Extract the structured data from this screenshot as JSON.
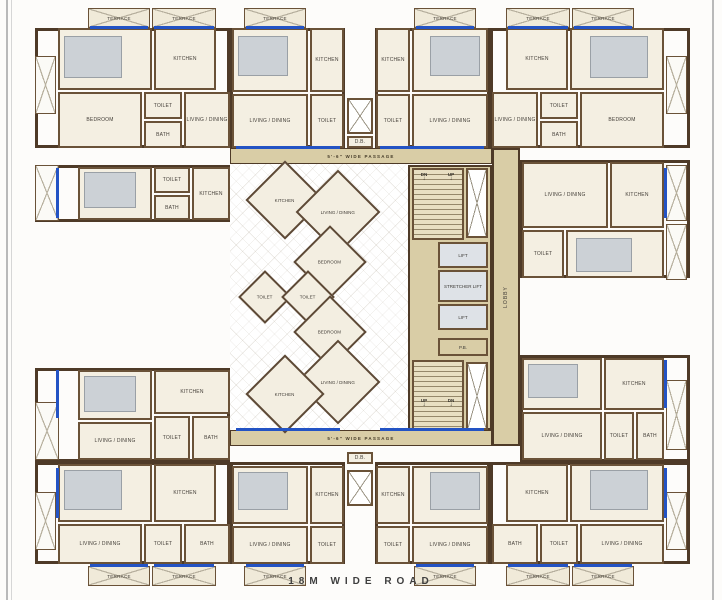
{
  "plan": {
    "road_label": "18M WIDE ROAD",
    "passage_top": "5'-6\" WIDE PASSAGE",
    "passage_bottom": "5'-6\" WIDE PASSAGE",
    "lobby_label": "LOBBY",
    "core": {
      "lift_top": "LIFT",
      "lift_middle": "STRETCHER LIFT",
      "lift_bottom": "LIFT",
      "pb_label": "P.B.",
      "stair_top_dn": "DN",
      "stair_top_up": "UP",
      "stair_bottom_up": "UP",
      "stair_bottom_dn": "DN"
    }
  },
  "colors": {
    "wall": "#6a5238",
    "outline": "#4e3a27",
    "room_fill": "#f4efe2",
    "terrace_fill": "#f0ead9",
    "passage_fill": "#d9cda6",
    "lift_fill": "#dee2e7",
    "window_blue": "#2353c4",
    "road_text": "#3f3f3f"
  },
  "plan_elements": {
    "wings": [
      {
        "x": 35,
        "y": 28,
        "w": 195,
        "h": 120
      },
      {
        "x": 230,
        "y": 28,
        "w": 115,
        "h": 120
      },
      {
        "x": 375,
        "y": 28,
        "w": 115,
        "h": 120
      },
      {
        "x": 490,
        "y": 28,
        "w": 200,
        "h": 120
      },
      {
        "x": 35,
        "y": 165,
        "w": 195,
        "h": 57
      },
      {
        "x": 520,
        "y": 160,
        "w": 170,
        "h": 118
      },
      {
        "x": 35,
        "y": 368,
        "w": 195,
        "h": 94
      },
      {
        "x": 520,
        "y": 355,
        "w": 170,
        "h": 107
      },
      {
        "x": 35,
        "y": 462,
        "w": 195,
        "h": 102
      },
      {
        "x": 230,
        "y": 462,
        "w": 115,
        "h": 102
      },
      {
        "x": 375,
        "y": 462,
        "w": 115,
        "h": 102
      },
      {
        "x": 490,
        "y": 462,
        "w": 200,
        "h": 102
      }
    ],
    "rooms": [
      {
        "x": 58,
        "y": 28,
        "w": 94,
        "h": 62,
        "label": "BEDROOM"
      },
      {
        "x": 154,
        "y": 28,
        "w": 62,
        "h": 62,
        "label": "KITCHEN"
      },
      {
        "x": 58,
        "y": 92,
        "w": 84,
        "h": 56,
        "label": "BEDROOM"
      },
      {
        "x": 144,
        "y": 92,
        "w": 38,
        "h": 27,
        "label": "TOILET"
      },
      {
        "x": 144,
        "y": 121,
        "w": 38,
        "h": 27,
        "label": "BATH"
      },
      {
        "x": 184,
        "y": 92,
        "w": 46,
        "h": 56,
        "label": "LIVING / DINING"
      },
      {
        "x": 232,
        "y": 28,
        "w": 76,
        "h": 64,
        "label": "BEDROOM"
      },
      {
        "x": 310,
        "y": 28,
        "w": 34,
        "h": 64,
        "label": "KITCHEN"
      },
      {
        "x": 232,
        "y": 94,
        "w": 76,
        "h": 54,
        "label": "LIVING / DINING"
      },
      {
        "x": 310,
        "y": 94,
        "w": 34,
        "h": 54,
        "label": "TOILET"
      },
      {
        "x": 376,
        "y": 28,
        "w": 34,
        "h": 64,
        "label": "KITCHEN"
      },
      {
        "x": 412,
        "y": 28,
        "w": 76,
        "h": 64,
        "label": "BEDROOM"
      },
      {
        "x": 376,
        "y": 94,
        "w": 34,
        "h": 54,
        "label": "TOILET"
      },
      {
        "x": 412,
        "y": 94,
        "w": 76,
        "h": 54,
        "label": "LIVING / DINING"
      },
      {
        "x": 506,
        "y": 28,
        "w": 62,
        "h": 62,
        "label": "KITCHEN"
      },
      {
        "x": 570,
        "y": 28,
        "w": 94,
        "h": 62,
        "label": "BEDROOM"
      },
      {
        "x": 492,
        "y": 92,
        "w": 46,
        "h": 56,
        "label": "LIVING / DINING"
      },
      {
        "x": 540,
        "y": 92,
        "w": 38,
        "h": 27,
        "label": "TOILET"
      },
      {
        "x": 540,
        "y": 121,
        "w": 38,
        "h": 27,
        "label": "BATH"
      },
      {
        "x": 580,
        "y": 92,
        "w": 84,
        "h": 56,
        "label": "BEDROOM"
      },
      {
        "x": 78,
        "y": 167,
        "w": 74,
        "h": 53,
        "label": "BEDROOM"
      },
      {
        "x": 154,
        "y": 167,
        "w": 36,
        "h": 26,
        "label": "TOILET"
      },
      {
        "x": 154,
        "y": 195,
        "w": 36,
        "h": 25,
        "label": "BATH"
      },
      {
        "x": 192,
        "y": 167,
        "w": 38,
        "h": 53,
        "label": "KITCHEN"
      },
      {
        "x": 522,
        "y": 162,
        "w": 86,
        "h": 66,
        "label": "LIVING / DINING"
      },
      {
        "x": 610,
        "y": 162,
        "w": 54,
        "h": 66,
        "label": "KITCHEN"
      },
      {
        "x": 522,
        "y": 230,
        "w": 42,
        "h": 48,
        "label": "TOILET"
      },
      {
        "x": 566,
        "y": 230,
        "w": 98,
        "h": 48,
        "label": "BEDROOM"
      },
      {
        "x": 78,
        "y": 370,
        "w": 74,
        "h": 50,
        "label": "BEDROOM"
      },
      {
        "x": 78,
        "y": 422,
        "w": 74,
        "h": 38,
        "label": "LIVING / DINING"
      },
      {
        "x": 154,
        "y": 370,
        "w": 76,
        "h": 44,
        "label": "KITCHEN"
      },
      {
        "x": 154,
        "y": 416,
        "w": 36,
        "h": 44,
        "label": "TOILET"
      },
      {
        "x": 192,
        "y": 416,
        "w": 38,
        "h": 44,
        "label": "BATH"
      },
      {
        "x": 522,
        "y": 358,
        "w": 80,
        "h": 52,
        "label": "BEDROOM"
      },
      {
        "x": 604,
        "y": 358,
        "w": 60,
        "h": 52,
        "label": "KITCHEN"
      },
      {
        "x": 522,
        "y": 412,
        "w": 80,
        "h": 48,
        "label": "LIVING / DINING"
      },
      {
        "x": 604,
        "y": 412,
        "w": 30,
        "h": 48,
        "label": "TOILET"
      },
      {
        "x": 636,
        "y": 412,
        "w": 28,
        "h": 48,
        "label": "BATH"
      },
      {
        "x": 58,
        "y": 464,
        "w": 94,
        "h": 58,
        "label": "BEDROOM"
      },
      {
        "x": 154,
        "y": 464,
        "w": 62,
        "h": 58,
        "label": "KITCHEN"
      },
      {
        "x": 58,
        "y": 524,
        "w": 84,
        "h": 40,
        "label": "LIVING / DINING"
      },
      {
        "x": 144,
        "y": 524,
        "w": 38,
        "h": 40,
        "label": "TOILET"
      },
      {
        "x": 184,
        "y": 524,
        "w": 46,
        "h": 40,
        "label": "BATH"
      },
      {
        "x": 232,
        "y": 466,
        "w": 76,
        "h": 58,
        "label": "BEDROOM"
      },
      {
        "x": 310,
        "y": 466,
        "w": 34,
        "h": 58,
        "label": "KITCHEN"
      },
      {
        "x": 232,
        "y": 526,
        "w": 76,
        "h": 38,
        "label": "LIVING / DINING"
      },
      {
        "x": 310,
        "y": 526,
        "w": 34,
        "h": 38,
        "label": "TOILET"
      },
      {
        "x": 376,
        "y": 466,
        "w": 34,
        "h": 58,
        "label": "KITCHEN"
      },
      {
        "x": 412,
        "y": 466,
        "w": 76,
        "h": 58,
        "label": "BEDROOM"
      },
      {
        "x": 376,
        "y": 526,
        "w": 34,
        "h": 38,
        "label": "TOILET"
      },
      {
        "x": 412,
        "y": 526,
        "w": 76,
        "h": 38,
        "label": "LIVING / DINING"
      },
      {
        "x": 506,
        "y": 464,
        "w": 62,
        "h": 58,
        "label": "KITCHEN"
      },
      {
        "x": 570,
        "y": 464,
        "w": 94,
        "h": 58,
        "label": "BEDROOM"
      },
      {
        "x": 492,
        "y": 524,
        "w": 46,
        "h": 40,
        "label": "BATH"
      },
      {
        "x": 540,
        "y": 524,
        "w": 38,
        "h": 40,
        "label": "TOILET"
      },
      {
        "x": 580,
        "y": 524,
        "w": 84,
        "h": 40,
        "label": "LIVING / DINING"
      },
      {
        "x": 347,
        "y": 136,
        "w": 26,
        "h": 12,
        "label": "D.B."
      },
      {
        "x": 347,
        "y": 452,
        "w": 26,
        "h": 12,
        "label": "D.B."
      }
    ],
    "terraces": [
      {
        "x": 88,
        "y": 8,
        "w": 62,
        "h": 20,
        "label": "TERRACE"
      },
      {
        "x": 152,
        "y": 8,
        "w": 64,
        "h": 20,
        "label": "TERRACE"
      },
      {
        "x": 244,
        "y": 8,
        "w": 62,
        "h": 20,
        "label": "TERRACE"
      },
      {
        "x": 414,
        "y": 8,
        "w": 62,
        "h": 20,
        "label": "TERRACE"
      },
      {
        "x": 506,
        "y": 8,
        "w": 64,
        "h": 20,
        "label": "TERRACE"
      },
      {
        "x": 572,
        "y": 8,
        "w": 62,
        "h": 20,
        "label": "TERRACE"
      },
      {
        "x": 88,
        "y": 566,
        "w": 62,
        "h": 20,
        "label": "TERRACE"
      },
      {
        "x": 152,
        "y": 566,
        "w": 64,
        "h": 20,
        "label": "TERRACE"
      },
      {
        "x": 244,
        "y": 566,
        "w": 62,
        "h": 20,
        "label": "TERRACE"
      },
      {
        "x": 414,
        "y": 566,
        "w": 62,
        "h": 20,
        "label": "TERRACE"
      },
      {
        "x": 506,
        "y": 566,
        "w": 64,
        "h": 20,
        "label": "TERRACE"
      },
      {
        "x": 572,
        "y": 566,
        "w": 62,
        "h": 20,
        "label": "TERRACE"
      }
    ],
    "hatches": [
      {
        "x": 35,
        "y": 56,
        "w": 21,
        "h": 58
      },
      {
        "x": 666,
        "y": 56,
        "w": 21,
        "h": 58
      },
      {
        "x": 35,
        "y": 165,
        "w": 24,
        "h": 56
      },
      {
        "x": 666,
        "y": 165,
        "w": 21,
        "h": 56
      },
      {
        "x": 666,
        "y": 224,
        "w": 21,
        "h": 56
      },
      {
        "x": 35,
        "y": 402,
        "w": 24,
        "h": 58
      },
      {
        "x": 666,
        "y": 380,
        "w": 21,
        "h": 70
      },
      {
        "x": 35,
        "y": 492,
        "w": 21,
        "h": 58
      },
      {
        "x": 666,
        "y": 492,
        "w": 21,
        "h": 58
      }
    ],
    "shafts": [
      {
        "x": 347,
        "y": 98,
        "w": 26,
        "h": 36
      },
      {
        "x": 347,
        "y": 470,
        "w": 26,
        "h": 36
      },
      {
        "x": 466,
        "y": 168,
        "w": 22,
        "h": 70
      },
      {
        "x": 466,
        "y": 362,
        "w": 22,
        "h": 68
      }
    ],
    "windows": [
      {
        "x": 90,
        "y": 26,
        "w": 58,
        "h": 3
      },
      {
        "x": 154,
        "y": 26,
        "w": 60,
        "h": 3
      },
      {
        "x": 246,
        "y": 26,
        "w": 58,
        "h": 3
      },
      {
        "x": 416,
        "y": 26,
        "w": 58,
        "h": 3
      },
      {
        "x": 508,
        "y": 26,
        "w": 60,
        "h": 3
      },
      {
        "x": 574,
        "y": 26,
        "w": 58,
        "h": 3
      },
      {
        "x": 90,
        "y": 564,
        "w": 58,
        "h": 3
      },
      {
        "x": 154,
        "y": 564,
        "w": 60,
        "h": 3
      },
      {
        "x": 246,
        "y": 564,
        "w": 58,
        "h": 3
      },
      {
        "x": 416,
        "y": 564,
        "w": 58,
        "h": 3
      },
      {
        "x": 508,
        "y": 564,
        "w": 60,
        "h": 3
      },
      {
        "x": 574,
        "y": 564,
        "w": 58,
        "h": 3
      },
      {
        "x": 56,
        "y": 168,
        "w": 3,
        "h": 50
      },
      {
        "x": 56,
        "y": 370,
        "w": 3,
        "h": 48
      },
      {
        "x": 56,
        "y": 468,
        "w": 3,
        "h": 50
      },
      {
        "x": 664,
        "y": 168,
        "w": 3,
        "h": 50
      },
      {
        "x": 664,
        "y": 360,
        "w": 3,
        "h": 48
      },
      {
        "x": 664,
        "y": 468,
        "w": 3,
        "h": 50
      },
      {
        "x": 236,
        "y": 146,
        "w": 104,
        "h": 3
      },
      {
        "x": 380,
        "y": 146,
        "w": 104,
        "h": 3
      },
      {
        "x": 236,
        "y": 428,
        "w": 104,
        "h": 3
      },
      {
        "x": 380,
        "y": 428,
        "w": 104,
        "h": 3
      }
    ],
    "furniture": [
      {
        "x": 64,
        "y": 36,
        "w": 58,
        "h": 42
      },
      {
        "x": 238,
        "y": 36,
        "w": 50,
        "h": 40
      },
      {
        "x": 430,
        "y": 36,
        "w": 50,
        "h": 40
      },
      {
        "x": 590,
        "y": 36,
        "w": 58,
        "h": 42
      },
      {
        "x": 84,
        "y": 172,
        "w": 52,
        "h": 36
      },
      {
        "x": 576,
        "y": 238,
        "w": 56,
        "h": 34
      },
      {
        "x": 84,
        "y": 376,
        "w": 52,
        "h": 36
      },
      {
        "x": 528,
        "y": 364,
        "w": 50,
        "h": 34
      },
      {
        "x": 64,
        "y": 470,
        "w": 58,
        "h": 40
      },
      {
        "x": 238,
        "y": 472,
        "w": 50,
        "h": 38
      },
      {
        "x": 430,
        "y": 472,
        "w": 50,
        "h": 38
      },
      {
        "x": 590,
        "y": 470,
        "w": 58,
        "h": 40
      }
    ],
    "diamonds": [
      {
        "cx": 285,
        "cy": 200,
        "s": 56,
        "label": "KITCHEN"
      },
      {
        "cx": 338,
        "cy": 212,
        "s": 60,
        "label": "LIVING / DINING"
      },
      {
        "cx": 330,
        "cy": 262,
        "s": 52,
        "label": "BEDROOM"
      },
      {
        "cx": 265,
        "cy": 297,
        "s": 38,
        "label": "TOILET"
      },
      {
        "cx": 308,
        "cy": 297,
        "s": 38,
        "label": "TOILET"
      },
      {
        "cx": 330,
        "cy": 332,
        "s": 52,
        "label": "BEDROOM"
      },
      {
        "cx": 338,
        "cy": 382,
        "s": 60,
        "label": "LIVING / DINING"
      },
      {
        "cx": 285,
        "cy": 394,
        "s": 56,
        "label": "KITCHEN"
      }
    ]
  }
}
